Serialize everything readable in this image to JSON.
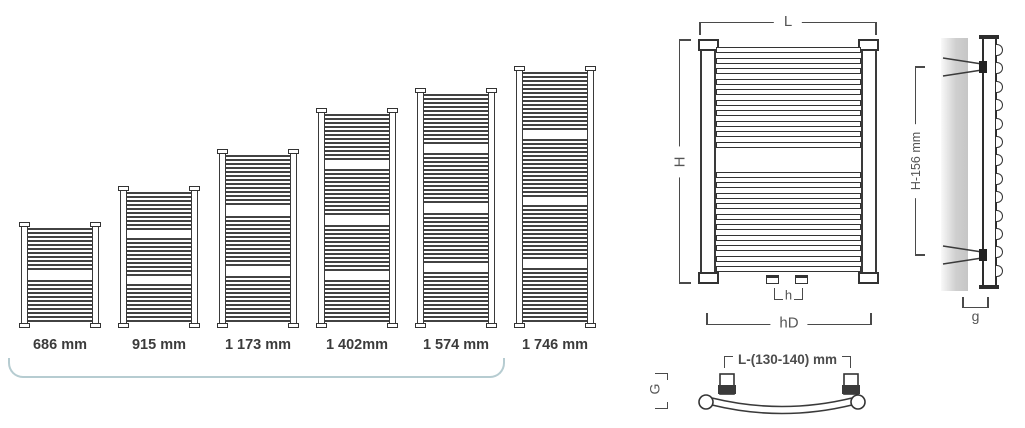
{
  "sizes": {
    "items": [
      {
        "label": "686 mm",
        "height_px": 106,
        "bar_groups": [
          11,
          11
        ]
      },
      {
        "label": "915 mm",
        "height_px": 142,
        "bar_groups": [
          10,
          10,
          10
        ]
      },
      {
        "label": "1 173 mm",
        "height_px": 179,
        "bar_groups": [
          13,
          13,
          12
        ]
      },
      {
        "label": "1 402mm",
        "height_px": 220,
        "bar_groups": [
          12,
          12,
          12,
          11
        ]
      },
      {
        "label": "1 574 mm",
        "height_px": 240,
        "bar_groups": [
          13,
          13,
          13,
          13
        ]
      },
      {
        "label": "1 746 mm",
        "height_px": 262,
        "bar_groups": [
          15,
          15,
          14,
          14
        ]
      }
    ]
  },
  "front_view": {
    "bar_groups": [
      10,
      10
    ],
    "labels": {
      "width": "L",
      "height": "H",
      "pipe_spacing": "h",
      "connection_spacing": "hD"
    }
  },
  "side_view": {
    "bump_count": 13,
    "labels": {
      "bracket_height": "H-156 mm",
      "depth": "g"
    }
  },
  "top_view": {
    "labels": {
      "bracket_spacing": "L-(130-140) mm",
      "bow_depth": "G"
    }
  },
  "colors": {
    "line": "#3a3a3a",
    "label": "#555555",
    "group_bracket": "#b6ccd1"
  }
}
